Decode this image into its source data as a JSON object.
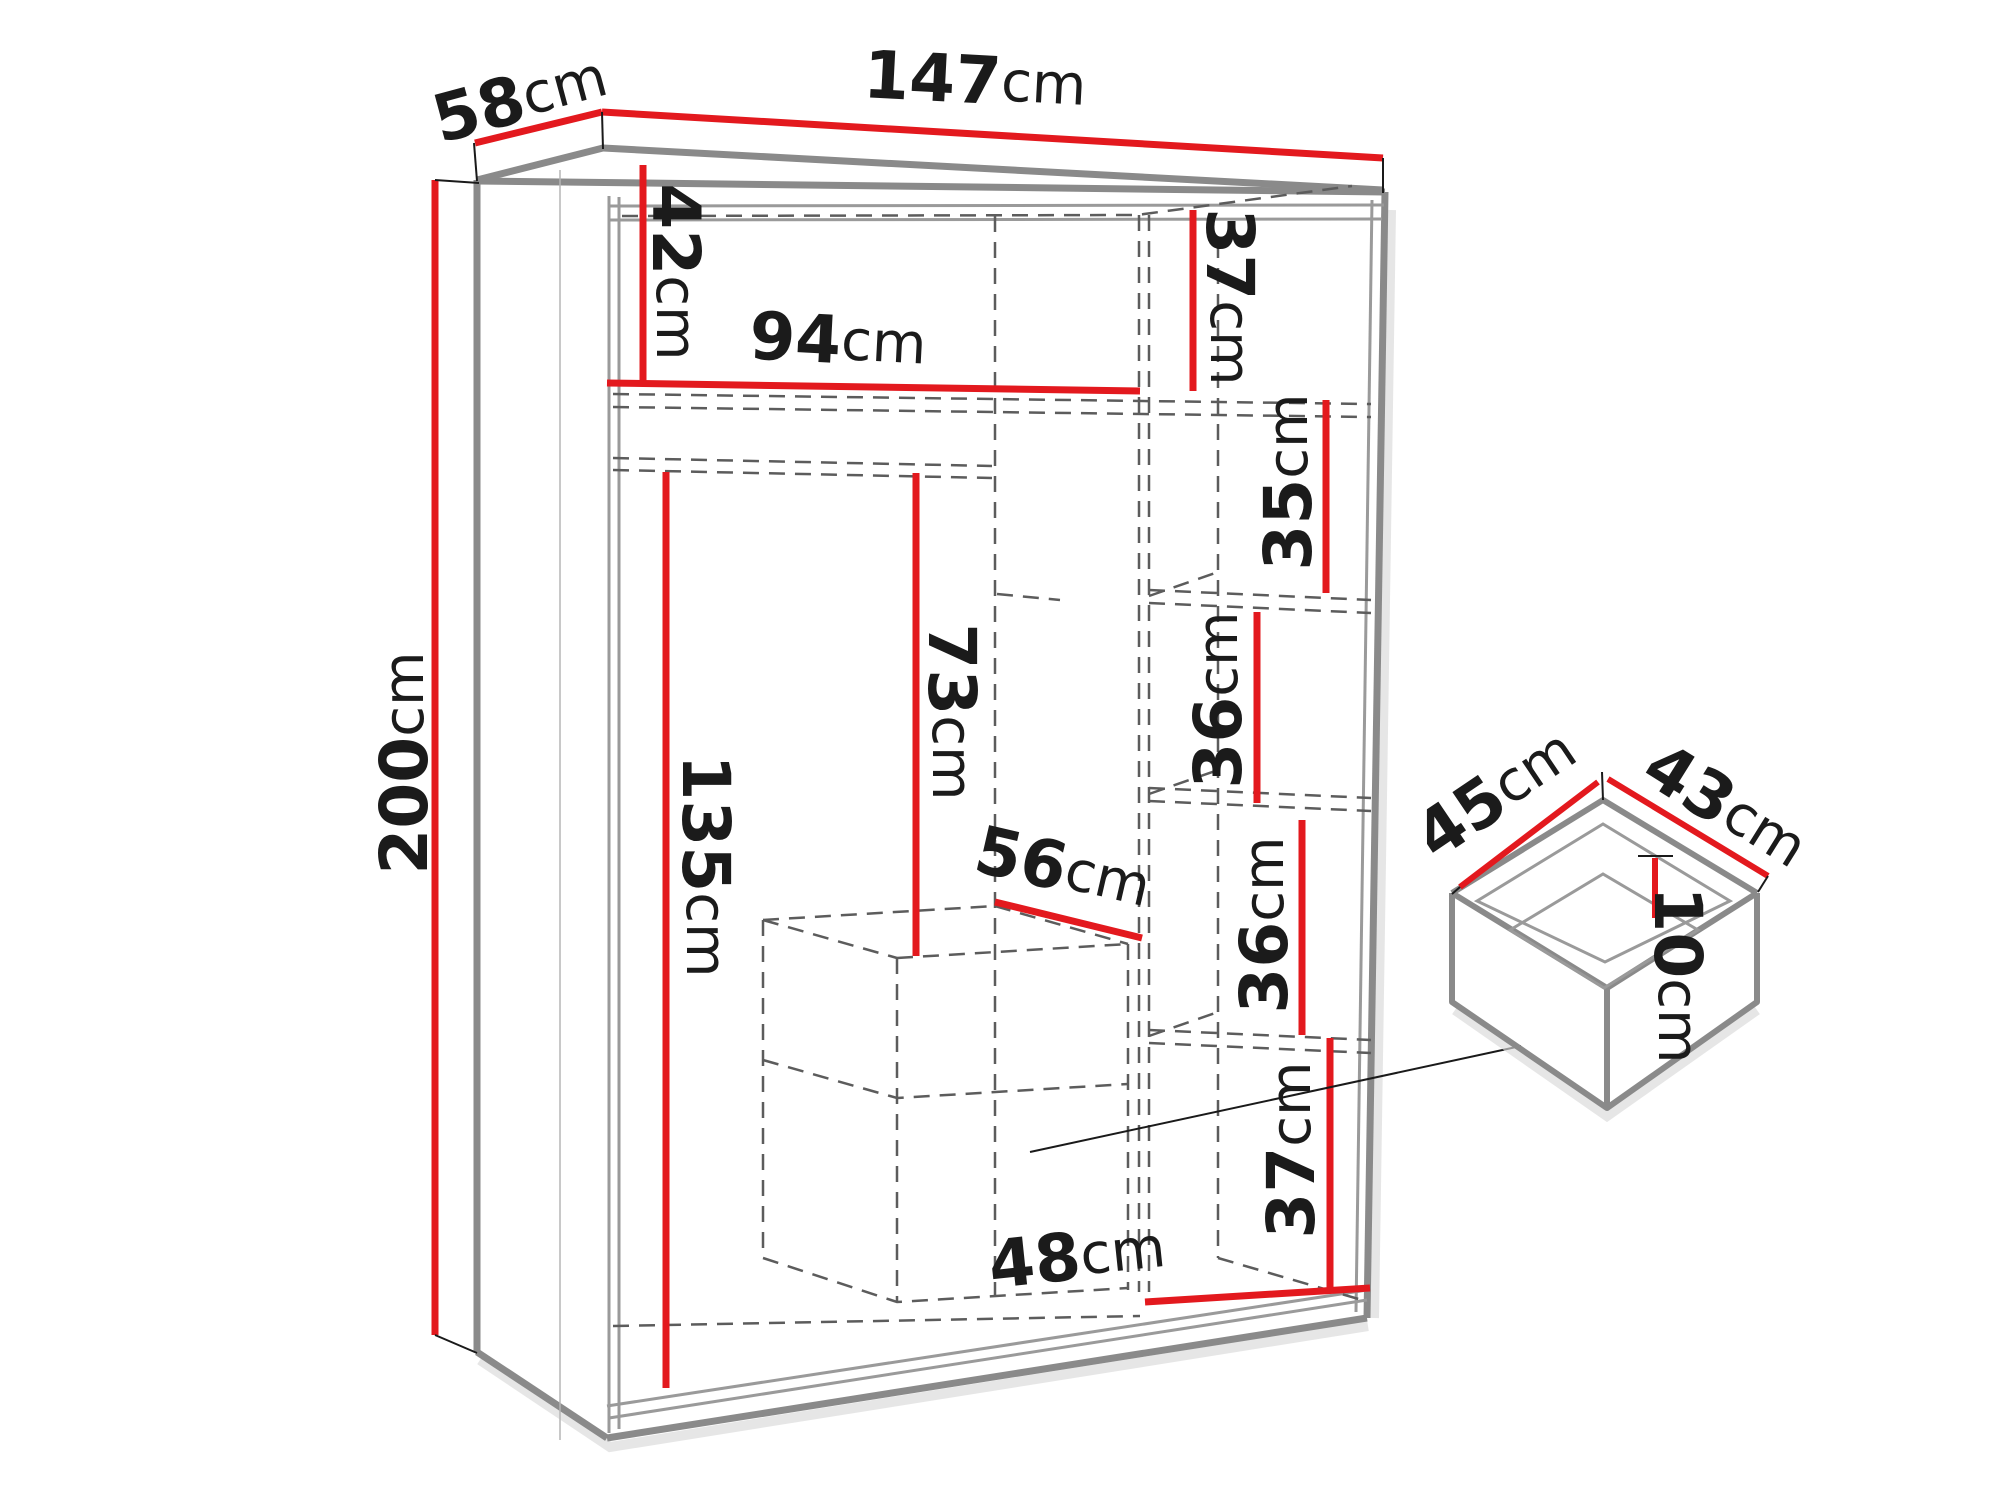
{
  "diagram_title": "wardrobe dimension drawing",
  "colors": {
    "dimension_line": "#e3191e",
    "cabinet_outline": "#8a8a8a",
    "interior_dashed": "#5c5c5c",
    "label_text": "#1b1b1b",
    "leader_line": "#1a1a1a"
  },
  "wardrobe": {
    "name": "sliding-door wardrobe",
    "overall": {
      "width": {
        "value": "147",
        "unit": "cm"
      },
      "depth": {
        "value": "58",
        "unit": "cm"
      },
      "height": {
        "value": "200",
        "unit": "cm"
      }
    },
    "interior": {
      "top_left_height": {
        "value": "42",
        "unit": "cm"
      },
      "top_shelf_width": {
        "value": "94",
        "unit": "cm"
      },
      "top_right_height": {
        "value": "37",
        "unit": "cm"
      },
      "right_shelf_1_height": {
        "value": "35",
        "unit": "cm"
      },
      "right_shelf_2_height": {
        "value": "36",
        "unit": "cm"
      },
      "right_shelf_3_height": {
        "value": "36",
        "unit": "cm"
      },
      "hanging_zone_height": {
        "value": "73",
        "unit": "cm"
      },
      "left_section_height": {
        "value": "135",
        "unit": "cm"
      },
      "drawer_unit_width": {
        "value": "56",
        "unit": "cm"
      },
      "bottom_right_height": {
        "value": "37",
        "unit": "cm"
      },
      "bottom_right_width": {
        "value": "48",
        "unit": "cm"
      }
    }
  },
  "drawer_detail": {
    "name": "internal drawer",
    "depth": {
      "value": "45",
      "unit": "cm"
    },
    "width": {
      "value": "43",
      "unit": "cm"
    },
    "inner_height": {
      "value": "10",
      "unit": "cm"
    }
  }
}
